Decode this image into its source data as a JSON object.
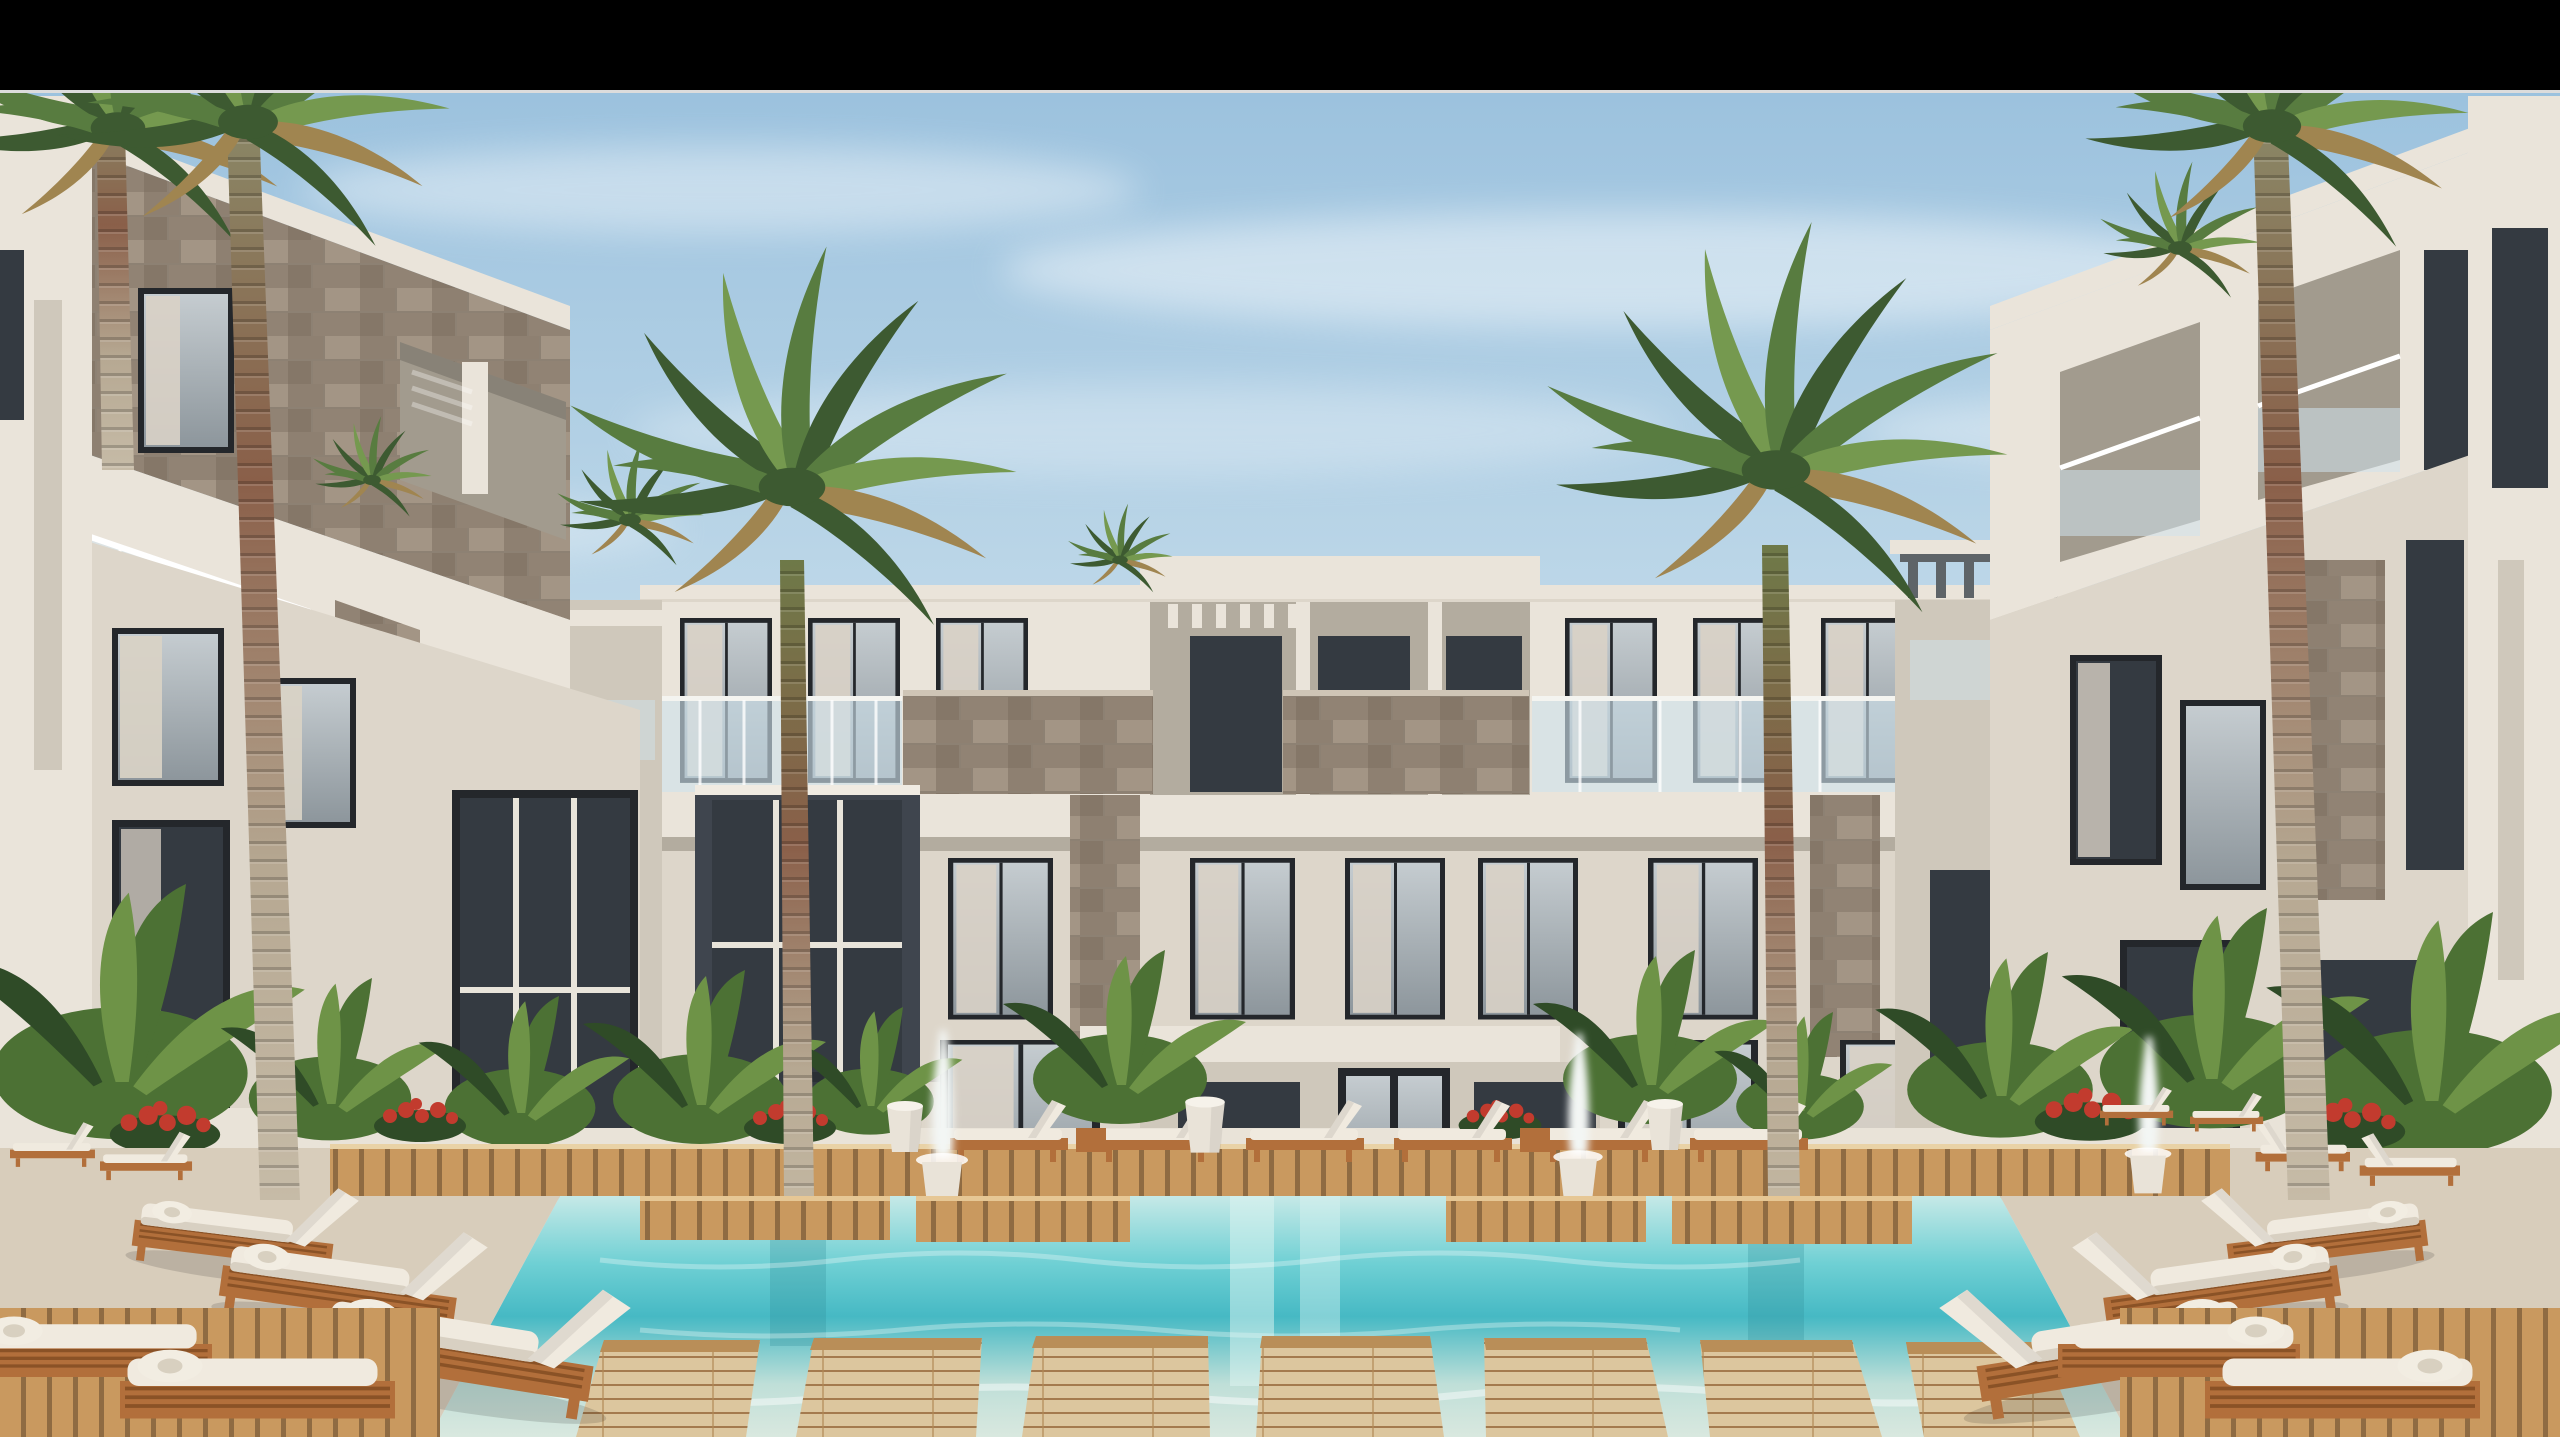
{
  "scene": {
    "type": "architectural-rendering",
    "description": "Daytime 3D rendering of a modern white resort apartment complex built around a turquoise courtyard swimming pool with wooden sun decks, white chaise lounges, stepping-stone wood platforms over the water, tropical planters with red and pink flowers, small white fountains and tall royal palm trees under a lightly clouded blue sky",
    "letterbox": "black bar across the top of the frame with a thin light divider line above the photo",
    "time_of_day": "day",
    "counts": {
      "tall_palms": 5,
      "small_palm_crowns": 4,
      "pool_fountains": 3,
      "far_deck_loungers": 6,
      "left_deck_loungers": 5,
      "right_deck_loungers": 7,
      "foreground_wood_platforms": 7,
      "building_floors": 3
    }
  },
  "palette": {
    "bar": "#000000",
    "divider": "#dcdcdc",
    "sky_top": "#9cc2de",
    "sky_mid": "#c3dbea",
    "sky_low": "#e4eef4",
    "cloud": "#ffffff",
    "wall_light": "#eae4da",
    "wall": "#ddd6ca",
    "wall_dim": "#cfc8bb",
    "wall_shadow": "#b3ac9f",
    "recess": "#a29b8e",
    "dark_recess": "#3f454e",
    "glass": "#b2bac0",
    "glass_dark": "#343a41",
    "frame": "#24272b",
    "curtain": "#d9d2c6",
    "stone_a": "#a39585",
    "stone_b": "#8e8071",
    "stone_c": "#7a6d5f",
    "rail_glass": "#cfe2ec",
    "rail_post": "#f4f4f0",
    "pergola": "#5e6468",
    "palm_dark": "#3d5a31",
    "palm_mid": "#587c40",
    "palm_light": "#75994f",
    "palm_dry": "#a08550",
    "trunk_top": "#6e7948",
    "trunk_red": "#8a5f49",
    "trunk_low": "#b6a892",
    "deck": "#c9995f",
    "deck_gap": "#8f6b42",
    "deck_light": "#dcc69e",
    "paving": "#d8cdbb",
    "wood_frame": "#b26f3b",
    "cushion": "#f0eadf",
    "cushion_shadow": "#d8d0c2",
    "water_far": "#c6e9e7",
    "water_mid": "#6fd0d4",
    "water_deep": "#46b9c4",
    "water_near": "#d9e8df",
    "planter": "#e9e3d8",
    "leaf_dark": "#2f4b27",
    "leaf": "#4c7134",
    "leaf_light": "#6e9347",
    "flower_red": "#c23b2e",
    "flower_pink": "#c5829f",
    "flower_purple": "#8f7aa8",
    "fountain": "#f3f6f4",
    "towel": "#f2ede2"
  }
}
